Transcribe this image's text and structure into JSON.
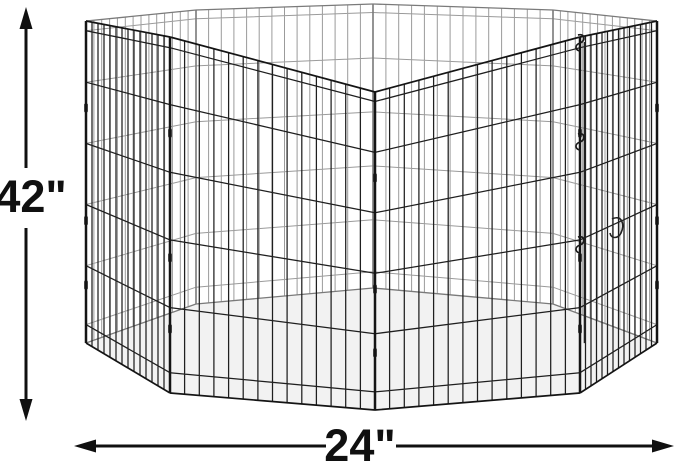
{
  "dimensions": {
    "height_label": "42\"",
    "width_label": "24\""
  },
  "pen": {
    "shape": "octagonal wire exercise pen viewed in perspective",
    "panel_count": 8,
    "verticals_per_panel": 13,
    "wire_fractions": [
      0.03,
      0.19,
      0.38,
      0.57,
      0.76,
      0.943
    ],
    "vertices": [
      [
        375,
        92,
        410
      ],
      [
        580,
        37,
        393
      ],
      [
        657,
        21,
        343
      ],
      [
        553,
        10,
        304
      ],
      [
        373,
        4,
        288
      ],
      [
        196,
        10,
        304
      ],
      [
        86,
        21,
        343
      ],
      [
        170,
        37,
        393
      ]
    ],
    "front_panels": [
      [
        6,
        7
      ],
      [
        7,
        0
      ],
      [
        0,
        1
      ],
      [
        1,
        2
      ]
    ],
    "back_panels": [
      [
        2,
        3
      ],
      [
        3,
        4
      ],
      [
        4,
        5
      ],
      [
        5,
        6
      ]
    ],
    "front_posts": [
      6,
      7,
      0,
      1,
      2
    ],
    "back_posts": [
      3,
      4,
      5
    ],
    "clip_fractions": [
      0.27,
      0.62,
      0.82
    ],
    "latch_post_index": 1,
    "colors": {
      "front_wire": "#1f1f1f",
      "front_frame": "#141414",
      "back_wire": "#9b9b9b",
      "back_frame": "#7a7a7a",
      "floor": "#f2f2f2",
      "annotation": "#101010",
      "background": "#ffffff"
    }
  }
}
